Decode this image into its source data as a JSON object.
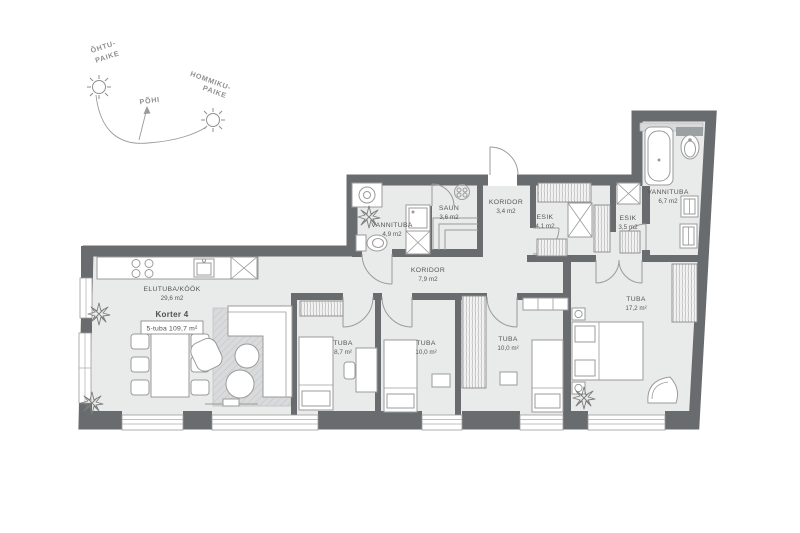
{
  "title": {
    "name": "Korter 4",
    "type": "5-tuba 109,7 m²"
  },
  "compass": {
    "west_line1": "ÕHTU-",
    "west_line2": "PAIKE",
    "north": "PÕHI",
    "east_line1": "HOMMIKU-",
    "east_line2": "PAIKE"
  },
  "rooms": {
    "living": {
      "name": "ELUTUBA/KÖÖK",
      "area": "29,6 m2"
    },
    "bath1": {
      "name": "VANNITUBA",
      "area": "4,9 m2"
    },
    "sauna": {
      "name": "SAUN",
      "area": "3,6 m2"
    },
    "corridor1": {
      "name": "KORIDOR",
      "area": "3,4 m2"
    },
    "hall1": {
      "name": "ESIK",
      "area": "4,1 m2"
    },
    "hall2": {
      "name": "ESIK",
      "area": "3,5 m2"
    },
    "bath2": {
      "name": "VANNITUBA",
      "area": "6,7 m2"
    },
    "corridor2": {
      "name": "KORIDOR",
      "area": "7,9 m2"
    },
    "bedroom1": {
      "name": "TUBA",
      "area": "8,7 m²"
    },
    "bedroom2": {
      "name": "TUBA",
      "area": "10,0 m²"
    },
    "bedroom3": {
      "name": "TUBA",
      "area": "10,0 m²"
    },
    "bedroom4": {
      "name": "TUBA",
      "area": "17,2 m²"
    }
  },
  "colors": {
    "wall": "#686c6f",
    "floor": "#e9eaea",
    "rug": "#d8dadb",
    "furniture_stroke": "#9b9b9b",
    "label_text": "#565656",
    "compass_text": "#8f8f8f",
    "background": "#ffffff"
  }
}
